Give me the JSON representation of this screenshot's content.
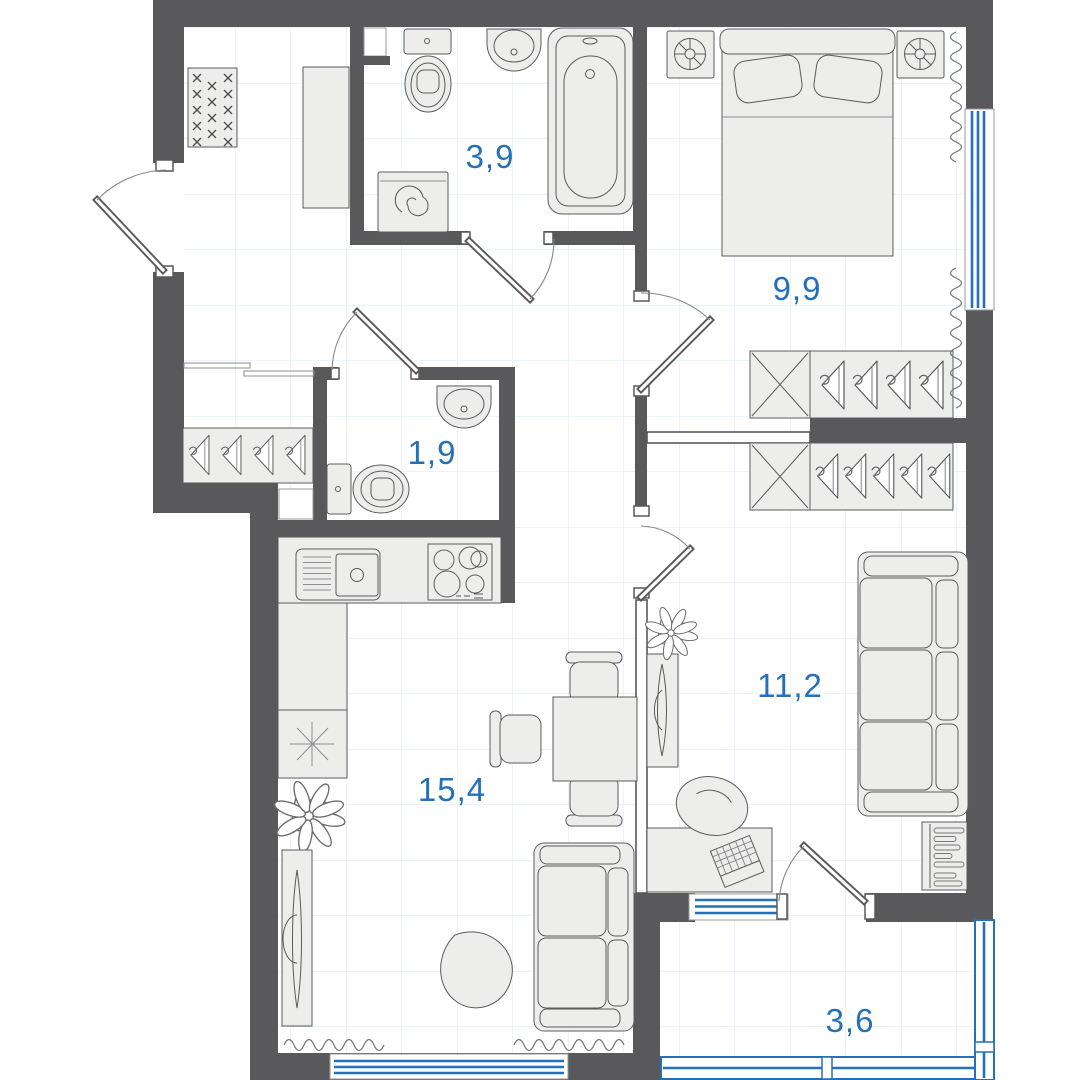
{
  "plan": {
    "type": "apartment-floor-plan",
    "area_labels": {
      "bathroom": "3,9",
      "bedroom": "9,9",
      "wc": "1,9",
      "room": "11,2",
      "kitchen_living": "15,4",
      "balcony": "3,6"
    },
    "colors": {
      "wall": "#59595B",
      "accent_blue": "#2471B9",
      "furniture_fill": "#EDEDEB",
      "grid_line": "#D9E9F7",
      "background": "#FFFFFF"
    },
    "icons": [
      "doormat-icon",
      "hall-cabinet-icon",
      "toilet-icon",
      "washbasin-icon",
      "washing-machine-icon",
      "bathtub-icon",
      "bed-icon",
      "pillow-icon",
      "nightstand-lamp-icon",
      "wardrobe-shelf-icon",
      "hanger-icon",
      "window-icon",
      "curtain-icon",
      "radiator-icon",
      "sofa-icon",
      "desk-icon",
      "laptop-icon",
      "office-chair-icon",
      "tv-console-icon",
      "plant-icon",
      "kitchen-sink-icon",
      "stove-icon",
      "fridge-icon",
      "dining-table-icon",
      "dining-chair-icon",
      "coffee-table-icon",
      "balcony-glazing-icon",
      "door-swing-icon"
    ]
  }
}
